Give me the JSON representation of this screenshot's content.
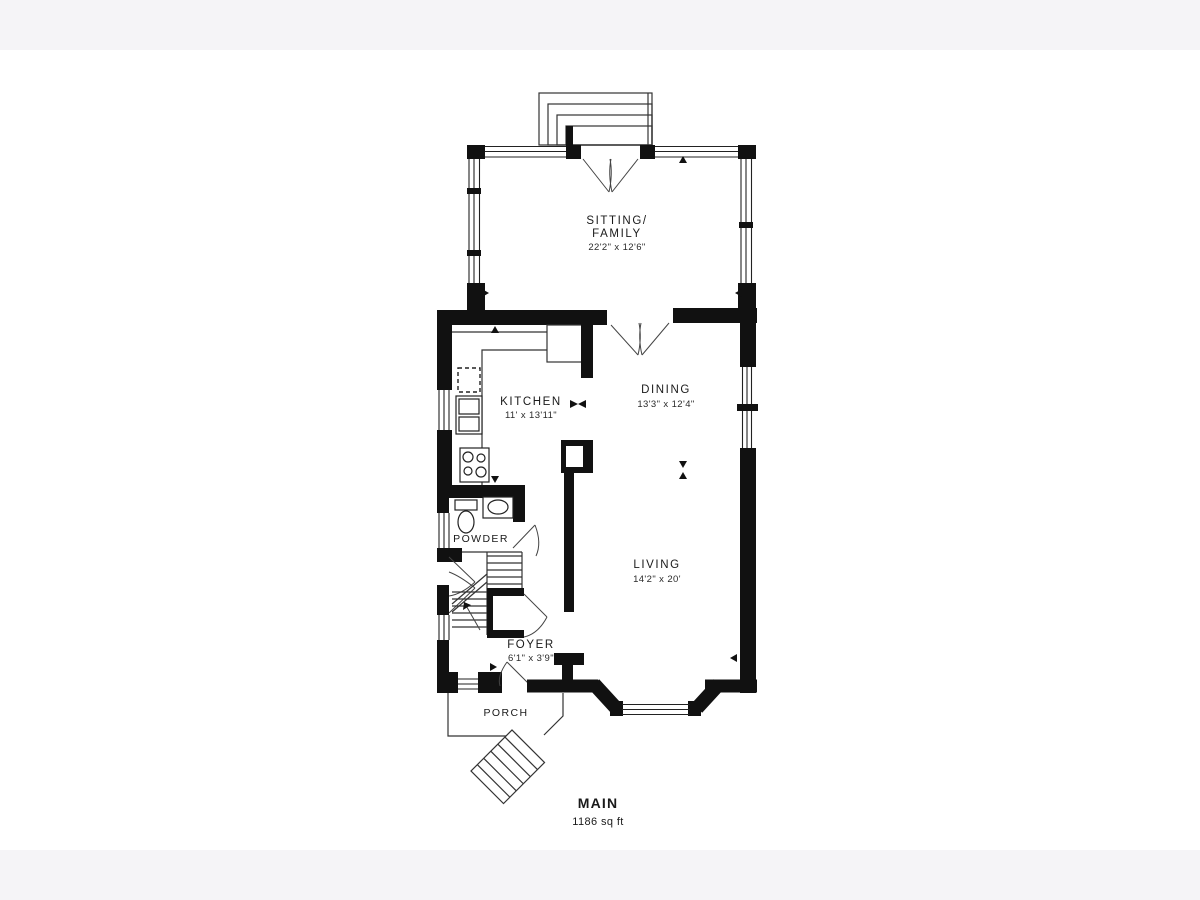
{
  "page": {
    "background_color": "#f5f4f7",
    "canvas_color": "#ffffff",
    "wall_color": "#111111",
    "line_color": "#333333",
    "text_color": "#1a1a1a"
  },
  "plan": {
    "floor_label": "MAIN",
    "floor_area": "1186 sq ft",
    "rooms": [
      {
        "id": "sitting",
        "name_line1": "SITTING/",
        "name_line2": "FAMILY",
        "dims": "22'2\" x 12'6\""
      },
      {
        "id": "kitchen",
        "name": "KITCHEN",
        "dims": "11' x 13'11\""
      },
      {
        "id": "dining",
        "name": "DINING",
        "dims": "13'3\" x 12'4\""
      },
      {
        "id": "living",
        "name": "LIVING",
        "dims": "14'2\" x 20'"
      },
      {
        "id": "powder",
        "name": "POWDER"
      },
      {
        "id": "foyer",
        "name": "FOYER",
        "dims": "6'1\" x 3'9\""
      },
      {
        "id": "porch",
        "name": "PORCH"
      }
    ]
  }
}
